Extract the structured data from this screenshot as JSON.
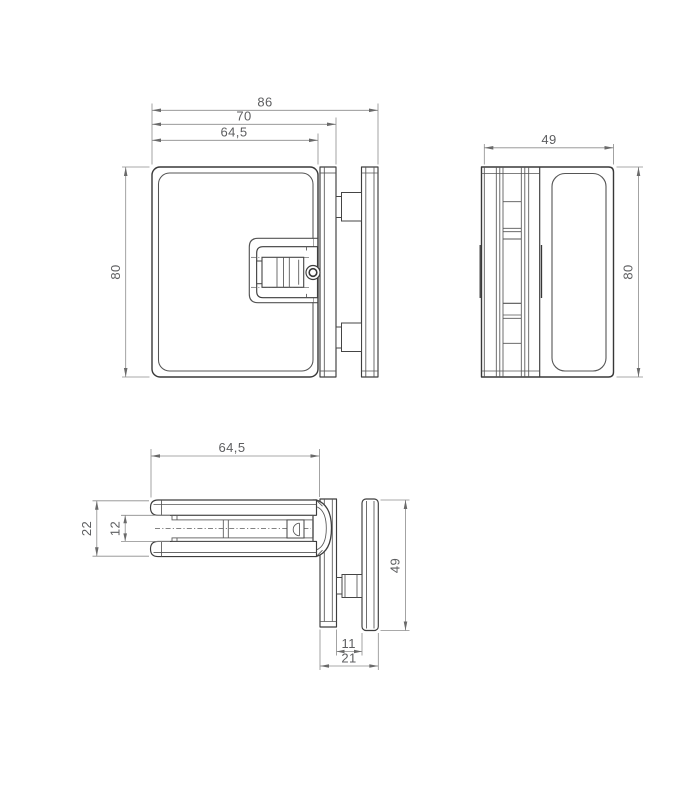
{
  "drawing": {
    "type": "technical-drawing",
    "part": "glass-clamp-hinge",
    "colors": {
      "line": "#383838",
      "dimension": "#8c8c8c",
      "text": "#5d5e60",
      "background": "#ffffff"
    },
    "front": {
      "dim_86": "86",
      "dim_70": "70",
      "dim_64_5": "64,5",
      "dim_80": "80"
    },
    "side": {
      "dim_49": "49",
      "dim_80": "80"
    },
    "top": {
      "dim_64_5": "64,5",
      "dim_22": "22",
      "dim_12": "12",
      "dim_49": "49",
      "dim_11": "11",
      "dim_21": "21"
    }
  }
}
